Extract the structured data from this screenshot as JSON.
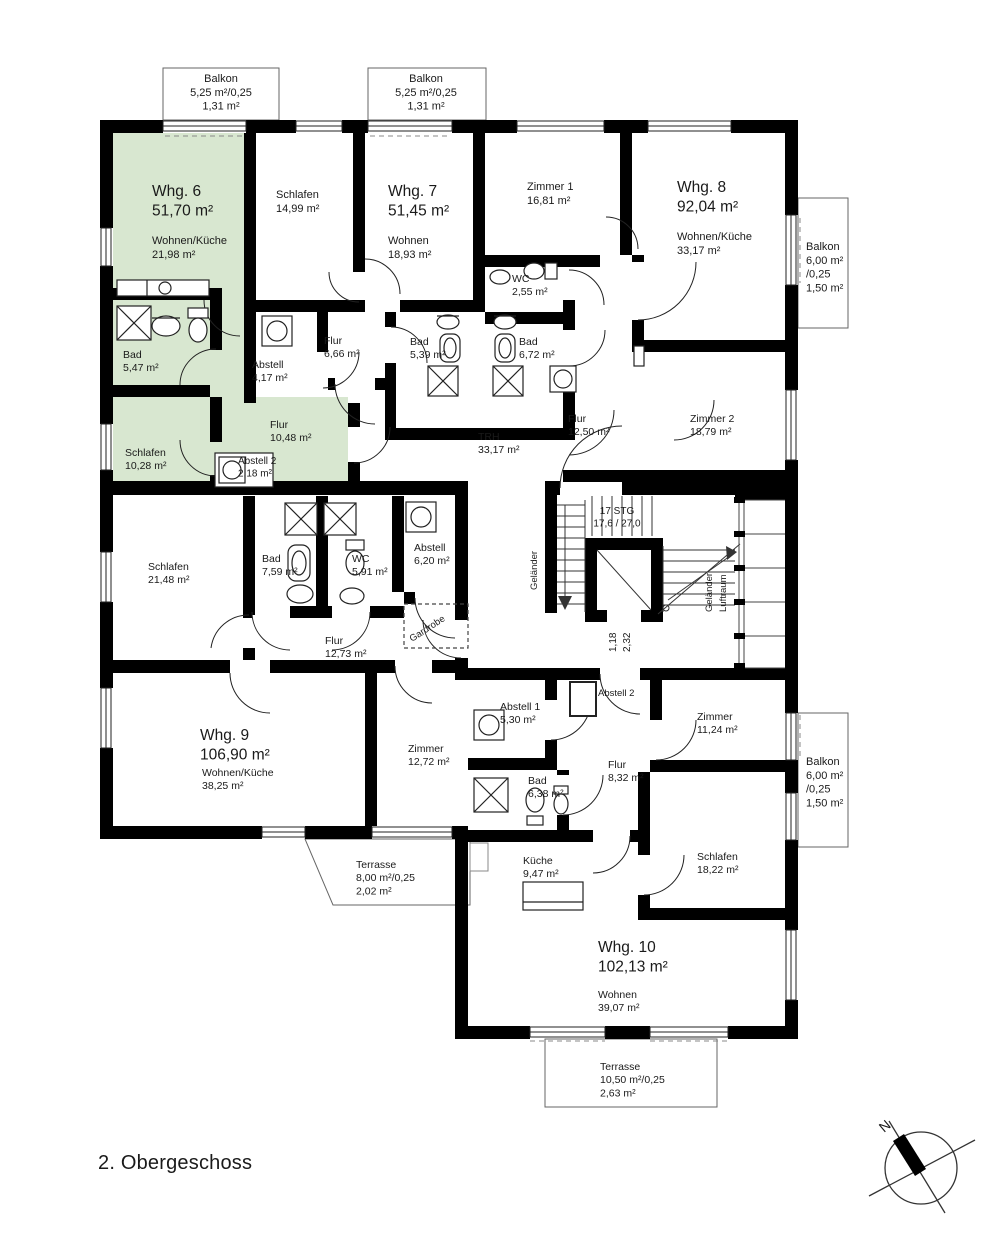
{
  "title": "2. Obergeschoss",
  "compass": {
    "north_label": "N"
  },
  "colors": {
    "wall": "#000000",
    "unit6_highlight": "#d8e7d0",
    "line": "#333333"
  },
  "labels": [
    {
      "name": "balkon-top-left-label",
      "x": 221,
      "y": 82,
      "size": 11,
      "anchor": "middle",
      "lines": [
        "Balkon",
        "5,25 m²/0,25",
        "1,31 m²"
      ]
    },
    {
      "name": "balkon-top-mid-label",
      "x": 426,
      "y": 82,
      "size": 11,
      "anchor": "middle",
      "lines": [
        "Balkon",
        "5,25 m²/0,25",
        "1,31 m²"
      ]
    },
    {
      "name": "whg6-title",
      "x": 152,
      "y": 196,
      "size": 15.5,
      "anchor": "start",
      "lines": [
        "Whg. 6",
        "51,70 m²"
      ]
    },
    {
      "name": "whg6-wohnen-kueche-label",
      "x": 152,
      "y": 244,
      "size": 11,
      "anchor": "start",
      "lines": [
        "Wohnen/Küche",
        "21,98 m²"
      ]
    },
    {
      "name": "whg7-schlafen-label",
      "x": 276,
      "y": 198,
      "size": 11,
      "anchor": "start",
      "lines": [
        "Schlafen",
        "14,99 m²"
      ]
    },
    {
      "name": "whg7-title",
      "x": 388,
      "y": 196,
      "size": 15.5,
      "anchor": "start",
      "lines": [
        "Whg. 7",
        "51,45 m²"
      ]
    },
    {
      "name": "whg7-wohnen-label",
      "x": 388,
      "y": 244,
      "size": 11,
      "anchor": "start",
      "lines": [
        "Wohnen",
        "18,93 m²"
      ]
    },
    {
      "name": "whg8-zimmer1-label",
      "x": 527,
      "y": 190,
      "size": 11,
      "anchor": "start",
      "lines": [
        "Zimmer 1",
        "16,81 m²"
      ]
    },
    {
      "name": "whg8-title",
      "x": 677,
      "y": 192,
      "size": 15.5,
      "anchor": "start",
      "lines": [
        "Whg. 8",
        "92,04 m²"
      ]
    },
    {
      "name": "whg8-wohnen-kueche-label",
      "x": 677,
      "y": 240,
      "size": 11,
      "anchor": "start",
      "lines": [
        "Wohnen/Küche",
        "33,17 m²"
      ]
    },
    {
      "name": "balkon-right-top-label",
      "x": 806,
      "y": 250,
      "size": 11,
      "anchor": "start",
      "lines": [
        "Balkon",
        "6,00 m²",
        "/0,25",
        "1,50 m²"
      ]
    },
    {
      "name": "whg8-wc-label",
      "x": 512,
      "y": 282,
      "size": 10.5,
      "anchor": "start",
      "lines": [
        "WC",
        "2,55 m²"
      ]
    },
    {
      "name": "whg6-bad-label",
      "x": 123,
      "y": 358,
      "size": 10.5,
      "anchor": "start",
      "lines": [
        "Bad",
        "5,47 m²"
      ]
    },
    {
      "name": "whg7-abstell-label",
      "x": 252,
      "y": 368,
      "size": 10.5,
      "anchor": "start",
      "lines": [
        "Abstell",
        "4,17 m²"
      ]
    },
    {
      "name": "whg7-flur-label",
      "x": 324,
      "y": 344,
      "size": 10.5,
      "anchor": "start",
      "lines": [
        "Flur",
        "6,66 m²"
      ]
    },
    {
      "name": "whg7-bad-label",
      "x": 410,
      "y": 345,
      "size": 10.5,
      "anchor": "start",
      "lines": [
        "Bad",
        "5,39 m²"
      ]
    },
    {
      "name": "whg8-bad-label",
      "x": 519,
      "y": 345,
      "size": 10.5,
      "anchor": "start",
      "lines": [
        "Bad",
        "6,72 m²"
      ]
    },
    {
      "name": "whg6-flur-label",
      "x": 270,
      "y": 428,
      "size": 10.5,
      "anchor": "start",
      "lines": [
        "Flur",
        "10,48 m²"
      ]
    },
    {
      "name": "whg6-schlafen-label",
      "x": 125,
      "y": 456,
      "size": 10.5,
      "anchor": "start",
      "lines": [
        "Schlafen",
        "10,28 m²"
      ]
    },
    {
      "name": "whg6-abstell2-label",
      "x": 238,
      "y": 464,
      "size": 10,
      "anchor": "start",
      "lines": [
        "Abstell 2",
        "2,18 m²"
      ]
    },
    {
      "name": "trh-label",
      "x": 478,
      "y": 440,
      "size": 10.5,
      "anchor": "start",
      "lines": [
        "TRH",
        "33,17 m²"
      ]
    },
    {
      "name": "whg8-flur-label",
      "x": 568,
      "y": 422,
      "size": 10.5,
      "anchor": "start",
      "lines": [
        "Flur",
        "12,50 m²"
      ]
    },
    {
      "name": "whg8-zimmer2-label",
      "x": 690,
      "y": 422,
      "size": 10.5,
      "anchor": "start",
      "lines": [
        "Zimmer 2",
        "18,79 m²"
      ]
    },
    {
      "name": "stairs-steps-label",
      "x": 617,
      "y": 514,
      "size": 10,
      "anchor": "middle",
      "lines": [
        "17 STG",
        "17,6 / 27,0"
      ]
    },
    {
      "name": "gelaender-left-label",
      "x": 537,
      "y": 590,
      "size": 9.5,
      "anchor": "start",
      "rotate": -90,
      "lines": [
        "Geländer"
      ]
    },
    {
      "name": "elevator-dim-118",
      "x": 616,
      "y": 652,
      "size": 10,
      "anchor": "start",
      "rotate": -90,
      "lines": [
        "1,18"
      ]
    },
    {
      "name": "elevator-dim-232",
      "x": 630,
      "y": 652,
      "size": 10,
      "anchor": "start",
      "rotate": -90,
      "lines": [
        "2,32"
      ]
    },
    {
      "name": "gelaender-right-label",
      "x": 712,
      "y": 612,
      "size": 9.5,
      "anchor": "start",
      "rotate": -90,
      "lines": [
        "Geländer"
      ]
    },
    {
      "name": "luftraum-label",
      "x": 726,
      "y": 612,
      "size": 9.5,
      "anchor": "start",
      "rotate": -90,
      "lines": [
        "Luftraum"
      ]
    },
    {
      "name": "whg9-schlafen-label",
      "x": 148,
      "y": 570,
      "size": 10.5,
      "anchor": "start",
      "lines": [
        "Schlafen",
        "21,48 m²"
      ]
    },
    {
      "name": "whg9-bad-label",
      "x": 262,
      "y": 562,
      "size": 10.5,
      "anchor": "start",
      "lines": [
        "Bad",
        "7,59 m²"
      ]
    },
    {
      "name": "whg9-wc-label",
      "x": 352,
      "y": 562,
      "size": 10.5,
      "anchor": "start",
      "lines": [
        "WC",
        "5,91 m²"
      ]
    },
    {
      "name": "whg9-abstell-label",
      "x": 414,
      "y": 551,
      "size": 10.5,
      "anchor": "start",
      "lines": [
        "Abstell",
        "6,20 m²"
      ]
    },
    {
      "name": "whg9-gardrobe-label",
      "x": 412,
      "y": 642,
      "size": 9.5,
      "anchor": "start",
      "rotate": -33,
      "lines": [
        "Gardrobe"
      ]
    },
    {
      "name": "whg9-flur-label",
      "x": 325,
      "y": 644,
      "size": 10.5,
      "anchor": "start",
      "lines": [
        "Flur",
        "12,73 m²"
      ]
    },
    {
      "name": "whg9-title",
      "x": 200,
      "y": 740,
      "size": 15.5,
      "anchor": "start",
      "lines": [
        "Whg. 9",
        "106,90 m²"
      ]
    },
    {
      "name": "whg9-wohnen-kueche-label",
      "x": 202,
      "y": 776,
      "size": 10.5,
      "anchor": "start",
      "lines": [
        "Wohnen/Küche",
        "38,25 m²"
      ]
    },
    {
      "name": "whg9-zimmer-label",
      "x": 408,
      "y": 752,
      "size": 10.5,
      "anchor": "start",
      "lines": [
        "Zimmer",
        "12,72 m²"
      ]
    },
    {
      "name": "terrasse-whg9-label",
      "x": 356,
      "y": 868,
      "size": 10.5,
      "anchor": "start",
      "lines": [
        "Terrasse",
        "8,00 m²/0,25",
        "2,02 m²"
      ]
    },
    {
      "name": "whg10-abstell1-label",
      "x": 500,
      "y": 710,
      "size": 10.5,
      "anchor": "start",
      "lines": [
        "Abstell 1",
        "5,30 m²"
      ]
    },
    {
      "name": "whg10-abstell2-label",
      "x": 598,
      "y": 696,
      "size": 9.5,
      "anchor": "start",
      "lines": [
        "Abstell 2"
      ]
    },
    {
      "name": "whg10-bad-label",
      "x": 528,
      "y": 784,
      "size": 10.5,
      "anchor": "start",
      "lines": [
        "Bad",
        "6,38 m²"
      ]
    },
    {
      "name": "whg10-flur-label",
      "x": 608,
      "y": 768,
      "size": 10.5,
      "anchor": "start",
      "lines": [
        "Flur",
        "8,32 m²"
      ]
    },
    {
      "name": "whg10-zimmer-label",
      "x": 697,
      "y": 720,
      "size": 10.5,
      "anchor": "start",
      "lines": [
        "Zimmer",
        "11,24 m²"
      ]
    },
    {
      "name": "whg10-schlafen-label",
      "x": 697,
      "y": 860,
      "size": 10.5,
      "anchor": "start",
      "lines": [
        "Schlafen",
        "18,22 m²"
      ]
    },
    {
      "name": "whg10-kueche-label",
      "x": 523,
      "y": 864,
      "size": 10.5,
      "anchor": "start",
      "lines": [
        "Küche",
        "9,47 m²"
      ]
    },
    {
      "name": "whg10-title",
      "x": 598,
      "y": 952,
      "size": 15.5,
      "anchor": "start",
      "lines": [
        "Whg. 10",
        "102,13 m²"
      ]
    },
    {
      "name": "whg10-wohnen-label",
      "x": 598,
      "y": 998,
      "size": 10.5,
      "anchor": "start",
      "lines": [
        "Wohnen",
        "39,07 m²"
      ]
    },
    {
      "name": "terrasse-whg10-label",
      "x": 600,
      "y": 1070,
      "size": 10.5,
      "anchor": "start",
      "lines": [
        "Terrasse",
        "10,50 m²/0,25",
        "2,63 m²"
      ]
    },
    {
      "name": "balkon-right-bottom-label",
      "x": 806,
      "y": 765,
      "size": 11,
      "anchor": "start",
      "lines": [
        "Balkon",
        "6,00 m²",
        "/0,25",
        "1,50 m²"
      ]
    },
    {
      "name": "compass-north-label",
      "x": 884,
      "y": 1133,
      "size": 14,
      "anchor": "start",
      "rotate": -40,
      "lines": [
        "N"
      ]
    }
  ]
}
